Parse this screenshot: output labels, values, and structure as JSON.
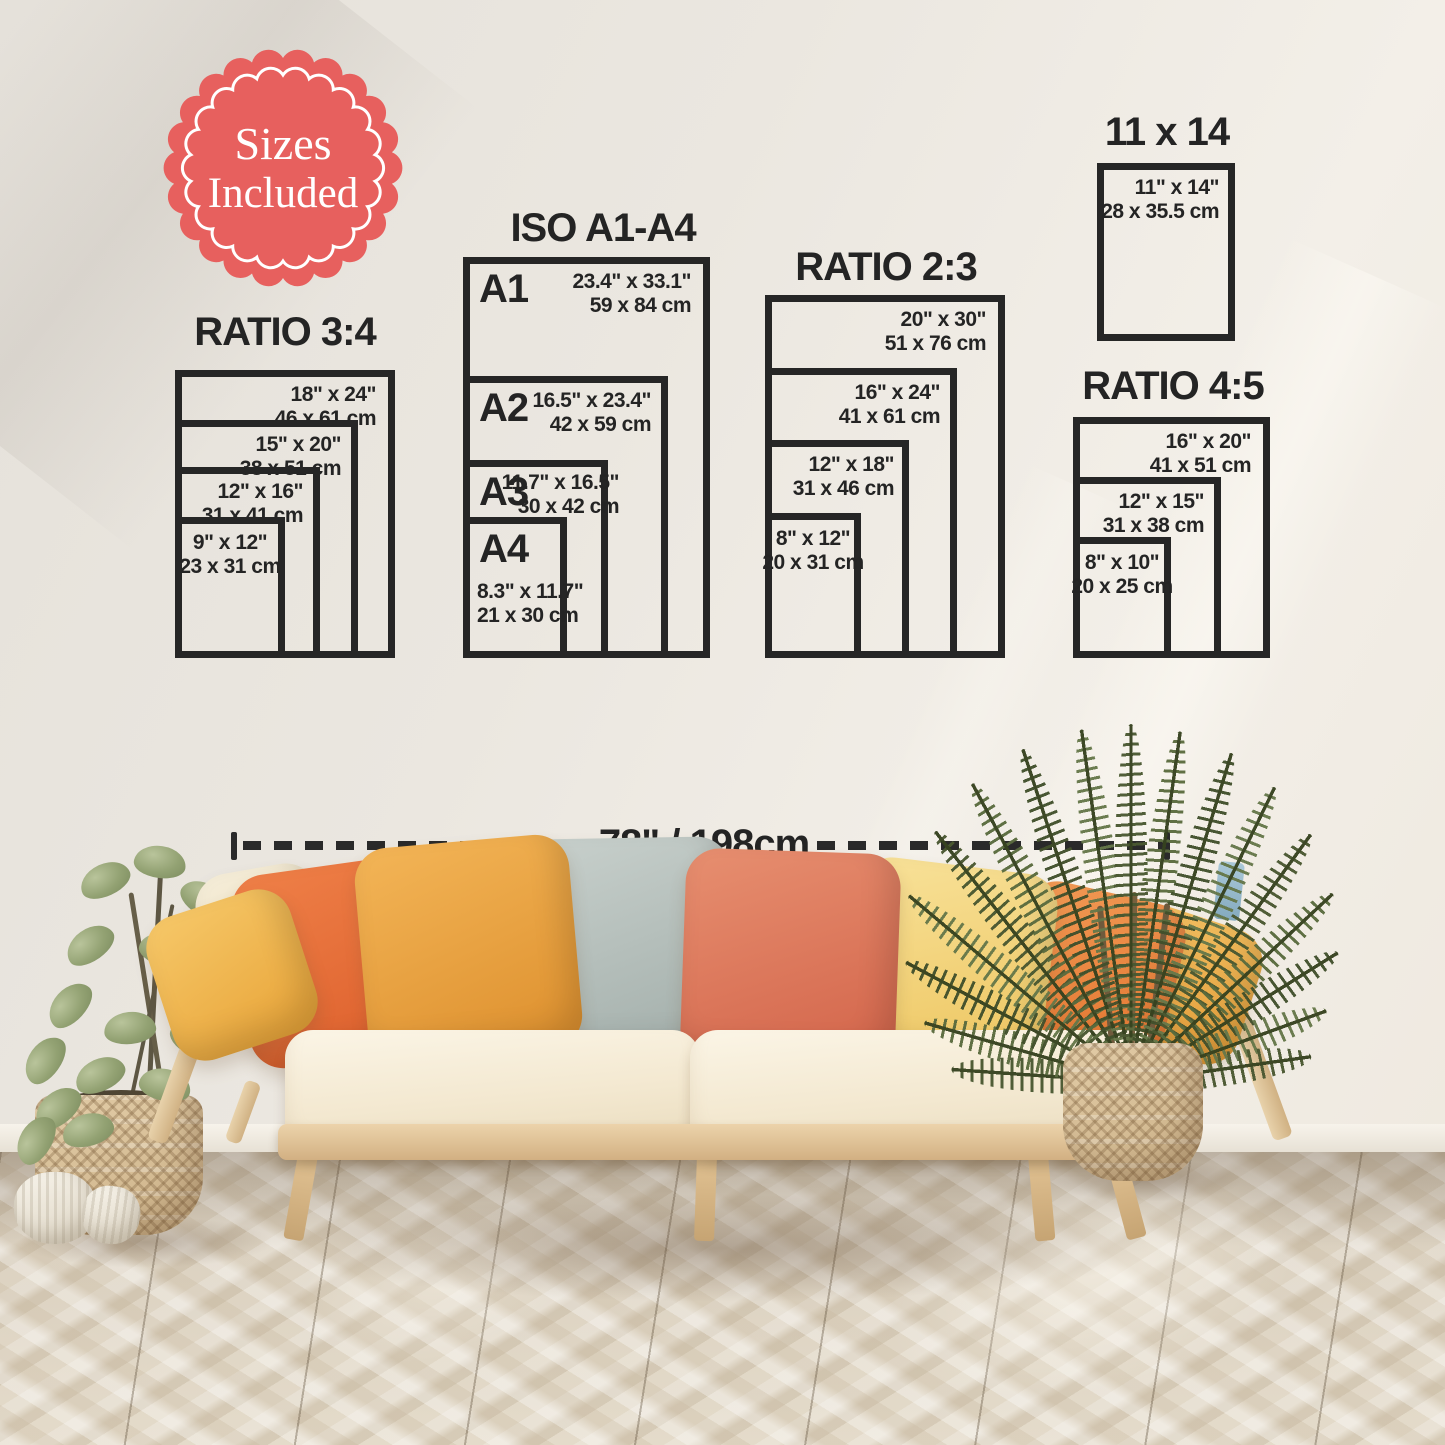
{
  "badge": {
    "line1": "Sizes",
    "line2": "Included"
  },
  "groups": [
    {
      "id": "ratio-3-4",
      "title": "RATIO 3:4",
      "sizes": [
        {
          "inch": "18\" x 24\"",
          "cm": "46 x 61 cm"
        },
        {
          "inch": "15\" x 20\"",
          "cm": "38 x 51 cm"
        },
        {
          "inch": "12\" x 16\"",
          "cm": "31 x 41 cm"
        },
        {
          "inch": "9\" x 12\"",
          "cm": "23 x 31 cm"
        }
      ]
    },
    {
      "id": "iso-a1-a4",
      "title": "ISO A1-A4",
      "sizes": [
        {
          "name": "A1",
          "inch": "23.4\" x 33.1\"",
          "cm": "59 x 84 cm"
        },
        {
          "name": "A2",
          "inch": "16.5\" x 23.4\"",
          "cm": "42 x 59 cm"
        },
        {
          "name": "A3",
          "inch": "11.7\" x 16.5\"",
          "cm": "30 x 42 cm"
        },
        {
          "name": "A4",
          "inch": "8.3\" x 11.7\"",
          "cm": "21 x 30 cm"
        }
      ]
    },
    {
      "id": "ratio-2-3",
      "title": "RATIO 2:3",
      "sizes": [
        {
          "inch": "20\" x 30\"",
          "cm": "51 x 76 cm"
        },
        {
          "inch": "16\" x 24\"",
          "cm": "41 x 61 cm"
        },
        {
          "inch": "12\" x 18\"",
          "cm": "31 x 46 cm"
        },
        {
          "inch": "8\" x 12\"",
          "cm": "20 x 31 cm"
        }
      ]
    },
    {
      "id": "size-11x14",
      "title": "11 x 14",
      "sizes": [
        {
          "inch": "11\" x 14\"",
          "cm": "28 x 35.5 cm"
        }
      ]
    },
    {
      "id": "ratio-4-5",
      "title": "RATIO 4:5",
      "sizes": [
        {
          "inch": "16\" x 20\"",
          "cm": "41 x 51 cm"
        },
        {
          "inch": "12\" x 15\"",
          "cm": "31 x 38 cm"
        },
        {
          "inch": "8\" x 10\"",
          "cm": "20 x 25 cm"
        }
      ]
    }
  ],
  "measure": {
    "label": "78\" / 198cm"
  },
  "colors": {
    "accent_red": "#e7605e",
    "diagram_ink": "#262626",
    "wall": "#ece8e1",
    "floor": "#dcd2c1"
  }
}
